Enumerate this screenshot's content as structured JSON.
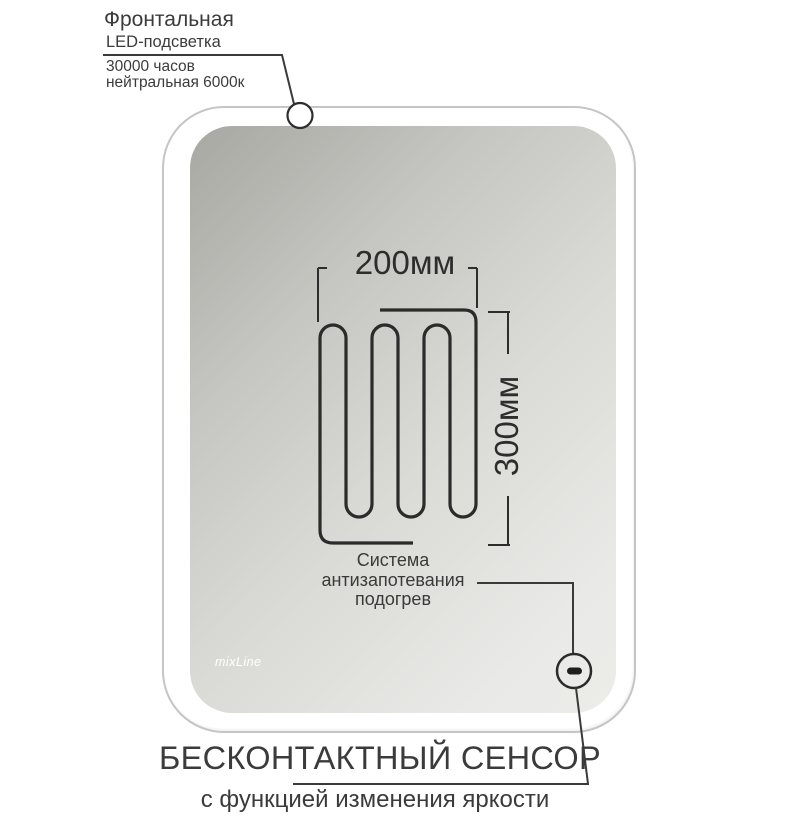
{
  "led_callout": {
    "title": "Фронтальная",
    "subtitle": "LED-подсветка",
    "details": [
      "30000 часов",
      "нейтральная 6000к"
    ]
  },
  "heater": {
    "width_label": "200мм",
    "height_label": "300мм",
    "caption": [
      "Система",
      "антизапотевания",
      "подогрев"
    ]
  },
  "sensor_callout": {
    "title": "БЕСКОНТАКТНЫЙ СЕНСОР",
    "subtitle": "с функцией изменения яркости"
  },
  "brand_logo": "mixLine",
  "colors": {
    "line_ink": "#2d2d2d",
    "text_ink": "#3b3b3b",
    "mirror_frame_stroke": "#c5c5c5",
    "glass_dark": "#a8a8a2",
    "glass_light": "#eceae9",
    "led_band": "#ffffff"
  }
}
